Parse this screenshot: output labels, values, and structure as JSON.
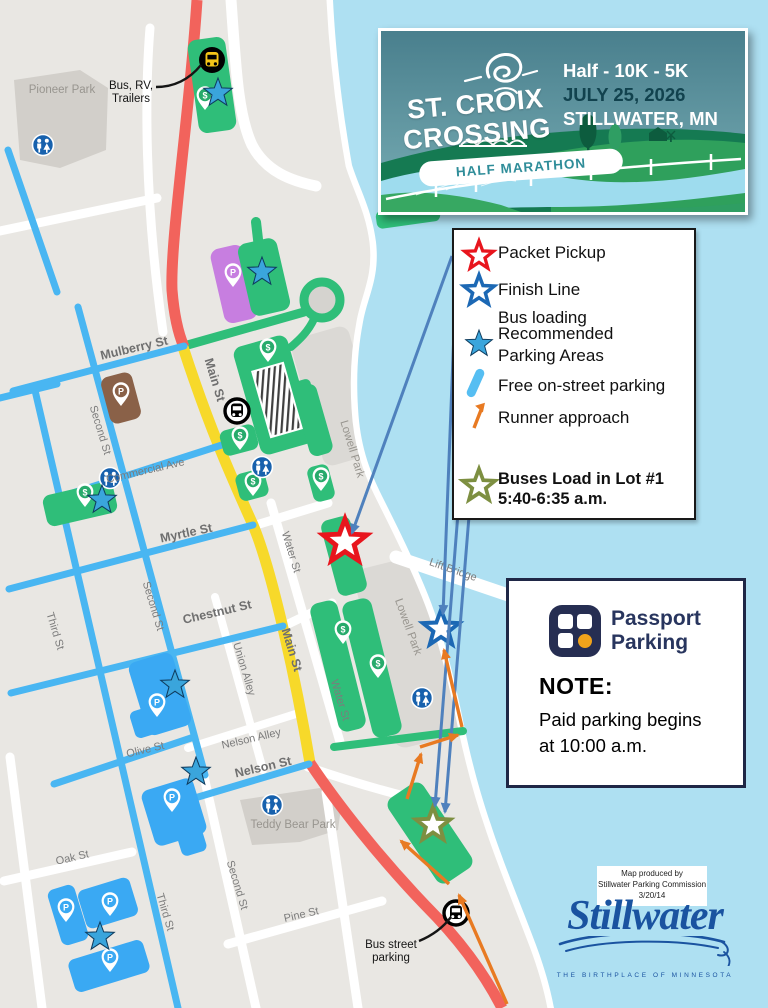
{
  "banner": {
    "title_line1": "ST. CROIX",
    "title_line2": "CROSSING",
    "tagline": "HALF MARATHON",
    "races": "Half - 10K - 5K",
    "date": "JULY 25, 2026",
    "city": "STILLWATER, MN"
  },
  "legend": {
    "items": [
      {
        "icon": "red-star-outline",
        "label": "Packet Pickup"
      },
      {
        "icon": "blue-star-outline",
        "label": "Finish Line"
      },
      {
        "icon": "none",
        "label": "Bus loading"
      },
      {
        "icon": "blue-star-filled",
        "label": "Recommended",
        "label2": "Parking Areas"
      },
      {
        "icon": "blue-line-swatch",
        "label": "Free on-street parking"
      },
      {
        "icon": "orange-arrow",
        "label": "Runner approach"
      },
      {
        "icon": "olive-star-outline",
        "label": "Buses Load in Lot #1",
        "label2": "5:40-6:35 a.m."
      }
    ]
  },
  "passport": {
    "brand_line1": "Passport",
    "brand_line2": "Parking",
    "note_title": "NOTE:",
    "note_line1": "Paid parking begins",
    "note_line2": "at 10:00 a.m."
  },
  "map": {
    "streets": {
      "mulberry": "Mulberry St",
      "main": "Main St",
      "second": "Second St",
      "third": "Third St",
      "commercial": "Commercial Ave",
      "myrtle": "Myrtle St",
      "water": "Water St",
      "chestnut": "Chestnut St",
      "union_alley": "Union Alley",
      "olive": "Olive St",
      "nelson_alley": "Nelson Alley",
      "nelson": "Nelson St",
      "oak": "Oak St",
      "pine": "Pine St",
      "lift_bridge": "Lift Bridge"
    },
    "parks": {
      "pioneer": "Pioneer Park",
      "lowell": "Lowell Park",
      "teddy": "Teddy Bear Park"
    },
    "labels": {
      "bus_rv_1": "Bus, RV,",
      "bus_rv_2": "Trailers",
      "bus_street_1": "Bus street",
      "bus_street_2": "parking"
    },
    "icons": {
      "dollar": "$",
      "parking": "P"
    }
  },
  "credit": {
    "line1": "Map produced by",
    "line2": "Stillwater Parking Commission",
    "line3": "3/20/14"
  },
  "city_logo": {
    "name": "Stillwater",
    "tagline": "THE BIRTHPLACE OF MINNESOTA"
  },
  "colors": {
    "water": "#aee0f2",
    "land": "#e9e7e3",
    "park": "#d2cfca",
    "free_parking_blue": "#49b6f2",
    "main_st_yellow": "#f7d92a",
    "highway_red": "#f2635c",
    "lot_green": "#2fbe79",
    "lot_blue": "#3aa9f3",
    "lot_purple": "#c77ee0",
    "lot_brown": "#8a6148",
    "star_blue": "#3aa5dc",
    "star_red": "#e8151d",
    "star_navy": "#1c68b4",
    "star_olive": "#7d8f41",
    "arrow_blue": "#4f81bd",
    "arrow_orange": "#e87a22",
    "passport_navy": "#262e52",
    "banner_teal": "#4f8f9b",
    "logo_blue": "#1a53a0"
  }
}
